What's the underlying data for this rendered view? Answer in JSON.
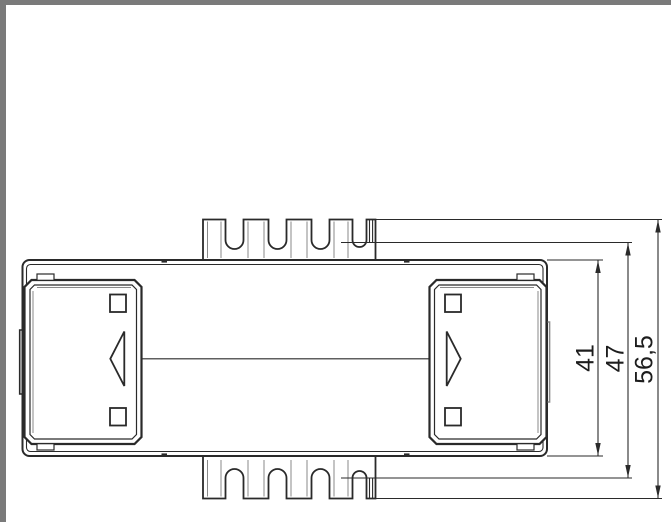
{
  "page": {
    "background": "#ffffff",
    "frame_color": "#7a7a7a"
  },
  "drawing": {
    "line_color": "#2a2a2a",
    "secondary_line_color": "#8a8a8a",
    "dimensions": [
      {
        "label": "41"
      },
      {
        "label": "47"
      },
      {
        "label": "56,5"
      }
    ]
  }
}
